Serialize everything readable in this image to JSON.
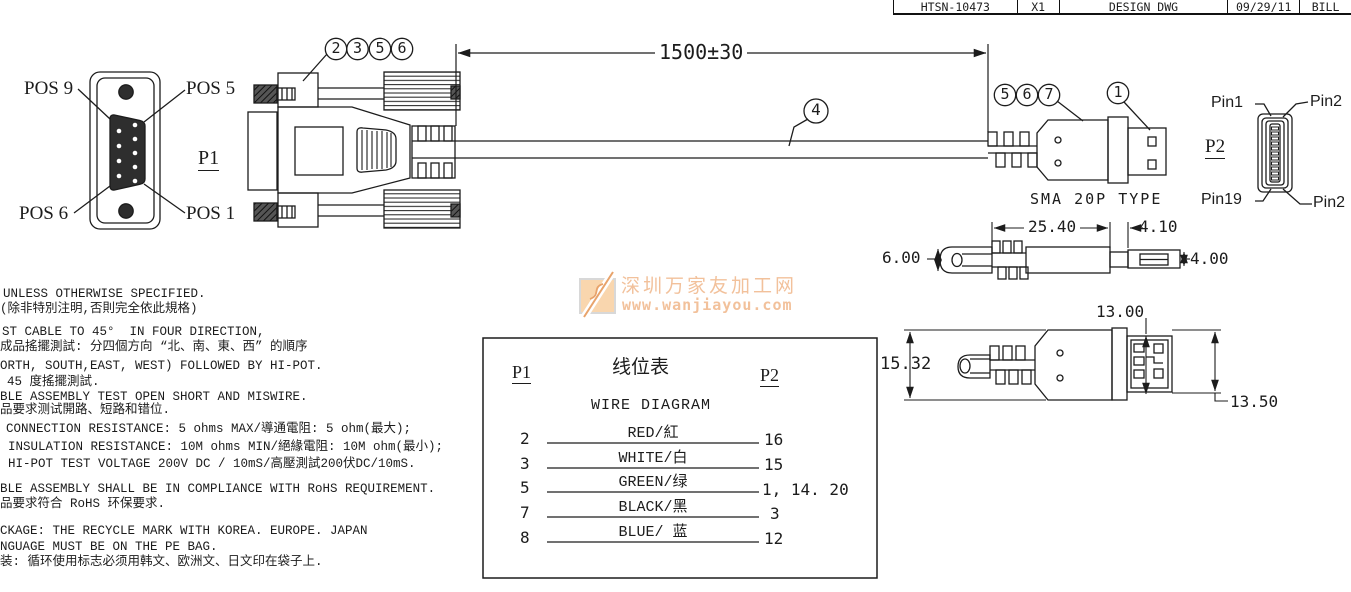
{
  "title_block": {
    "cells": [
      "HTSN-10473",
      "X1",
      "DESIGN DWG",
      "09/29/11",
      "BILL"
    ]
  },
  "p1_view": {
    "label": "P1",
    "pos_top_left": "POS 9",
    "pos_top_right": "POS 5",
    "pos_bottom_left": "POS 6",
    "pos_bottom_right": "POS 1"
  },
  "p2_view": {
    "label": "P2",
    "pin_top_left": "Pin1",
    "pin_top_right": "Pin2",
    "pin_bottom_left": "Pin19",
    "pin_bottom_right": "Pin2",
    "connector_label": "SMA 20P TYPE"
  },
  "callouts": {
    "db9_group": [
      "2",
      "3",
      "5",
      "6"
    ],
    "cable": "4",
    "sma_group": [
      "5",
      "6",
      "7"
    ],
    "sma_tip": "1"
  },
  "dimensions": {
    "cable_length": "1500±30",
    "body_length": "25.40",
    "neck_length": "4.10",
    "cable_diameter": "6.00",
    "tip_diameter": "4.00",
    "body_height": "15.32",
    "tip_height": "13.00",
    "overall_height": "13.50"
  },
  "wire_table": {
    "p1_header": "P1",
    "p2_header": "P2",
    "title_cn": "线位表",
    "title_en": "WIRE DIAGRAM",
    "rows": [
      {
        "p1": "2",
        "wire": "RED/紅",
        "p2": "16"
      },
      {
        "p1": "3",
        "wire": "WHITE/白",
        "p2": "15"
      },
      {
        "p1": "5",
        "wire": "GREEN/绿",
        "p2": "1, 14. 20"
      },
      {
        "p1": "7",
        "wire": "BLACK/黑",
        "p2": "3"
      },
      {
        "p1": "8",
        "wire": "BLUE/ 蓝",
        "p2": "12"
      }
    ]
  },
  "notes": {
    "lines": [
      "UNLESS OTHERWISE SPECIFIED.",
      "(除非特別注明,否則完全依此規格)",
      "ST CABLE TO 45°  IN FOUR DIRECTION,",
      "成品搖擺測試: 分四個方向 “北、南、東、西” 的順序",
      "ORTH, SOUTH,EAST, WEST) FOLLOWED BY HI-POT.",
      "45 度搖擺測試.",
      "BLE ASSEMBLY TEST OPEN SHORT AND MISWIRE.",
      "品要求测试開路、短路和错位.",
      "CONNECTION RESISTANCE: 5 ohms MAX/導通電阻: 5 ohm(最大);",
      "INSULATION RESISTANCE: 10M ohms MIN/絕緣電阻: 10M ohm(最小);",
      "HI-POT TEST VOLTAGE 200V DC / 10mS/高壓測試200伏DC/10mS.",
      "BLE ASSEMBLY SHALL BE IN COMPLIANCE WITH RoHS REQUIREMENT.",
      "品要求符合 RoHS 环保要求.",
      "CKAGE: THE RECYCLE MARK WITH KOREA. EUROPE. JAPAN",
      "NGUAGE MUST BE ON THE PE BAG.",
      "装: 循环使用标志必须用韩文、欧洲文、日文印在袋子上."
    ]
  },
  "watermark": {
    "site_name": "深圳万家友加工网",
    "url": "www.wanjiayou.com",
    "text_color": "#f2c19b",
    "accent_color": "#e8a36b"
  },
  "colors": {
    "line": "#1c1c1c"
  }
}
